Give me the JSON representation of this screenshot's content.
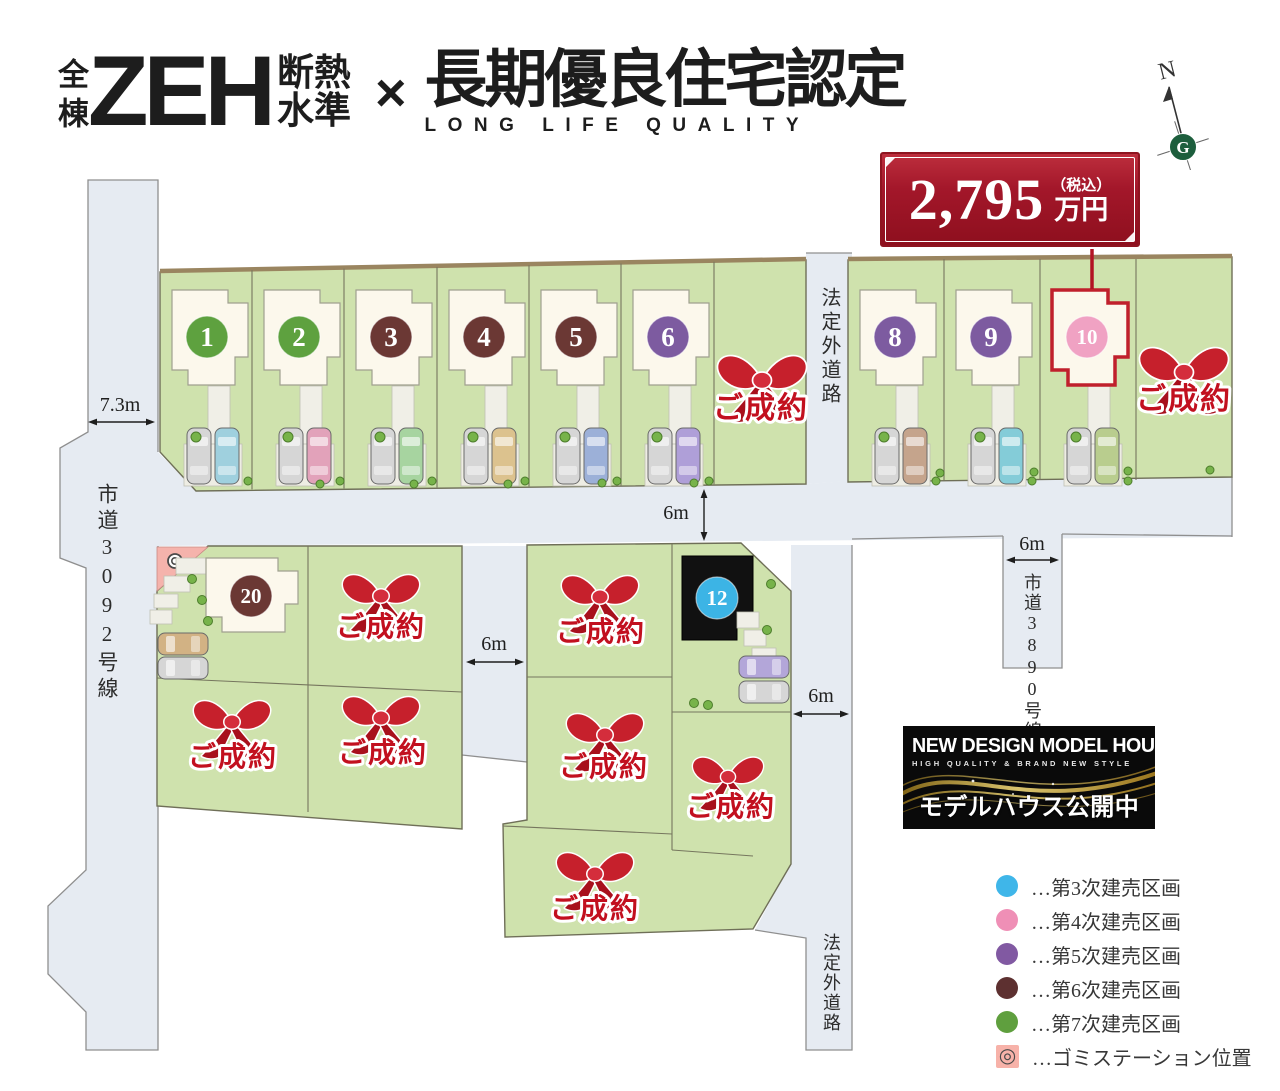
{
  "header": {
    "badge_vertical": "全棟",
    "zeh": "ZEH",
    "zeh_note_line1": "断熱",
    "zeh_note_line2": "水準",
    "cross": "×",
    "title": "長期優良住宅認定",
    "subtitle": "LONG LIFE QUALITY"
  },
  "compass": {
    "north": "N"
  },
  "price_badge": {
    "amount": "2,795",
    "tax_note": "（税込）",
    "unit": "万円"
  },
  "map": {
    "sold_label": "ご成約",
    "roads": {
      "west": "市道3092号線",
      "north_branch": "法定外道路",
      "east_branch": "市道3890号線",
      "south_branch": "法定外道路"
    },
    "measurements": {
      "west_width": "7.3m",
      "standard_width": "6m"
    },
    "phase_colors": {
      "p3": "#3cb4e5",
      "p4": "#f0a2c3",
      "p5": "#7d5ba0",
      "p6": "#6b3834",
      "p7": "#5ea13f"
    },
    "numbered_lots": [
      {
        "number": "1",
        "phase": "p7"
      },
      {
        "number": "2",
        "phase": "p7"
      },
      {
        "number": "3",
        "phase": "p6"
      },
      {
        "number": "4",
        "phase": "p6"
      },
      {
        "number": "5",
        "phase": "p6"
      },
      {
        "number": "6",
        "phase": "p5"
      },
      {
        "number": "8",
        "phase": "p5"
      },
      {
        "number": "9",
        "phase": "p5"
      },
      {
        "number": "10",
        "phase": "p4",
        "highlighted": true
      },
      {
        "number": "20",
        "phase": "p6"
      },
      {
        "number": "12",
        "phase": "p3"
      }
    ]
  },
  "model_house_banner": {
    "title": "NEW DESIGN MODEL HOUSE",
    "subtitle": "HIGH QUALITY & BRAND NEW STYLE",
    "caption": "モデルハウス公開中"
  },
  "legend": {
    "items": [
      {
        "swatch": "#3fb6e9",
        "label": "…第3次建売区画"
      },
      {
        "swatch": "#ef8fb6",
        "label": "…第4次建売区画"
      },
      {
        "swatch": "#8159a2",
        "label": "…第5次建売区画"
      },
      {
        "swatch": "#5d3030",
        "label": "…第6次建売区画"
      },
      {
        "swatch": "#5f9f3e",
        "label": "…第7次建売区画"
      },
      {
        "swatch": "#f7b2a9",
        "symbol": "◎",
        "label": "…ゴミステーション位置",
        "type": "gomi"
      }
    ]
  },
  "colors": {
    "sold_red": "#c2101f",
    "highlight_red": "#c0202c",
    "road_fill": "#e6ebf2",
    "lot_green": "#cfe2ad",
    "house_cream": "#fcf8ec",
    "model_house_black": "#111111",
    "connector_red": "#b21323"
  }
}
